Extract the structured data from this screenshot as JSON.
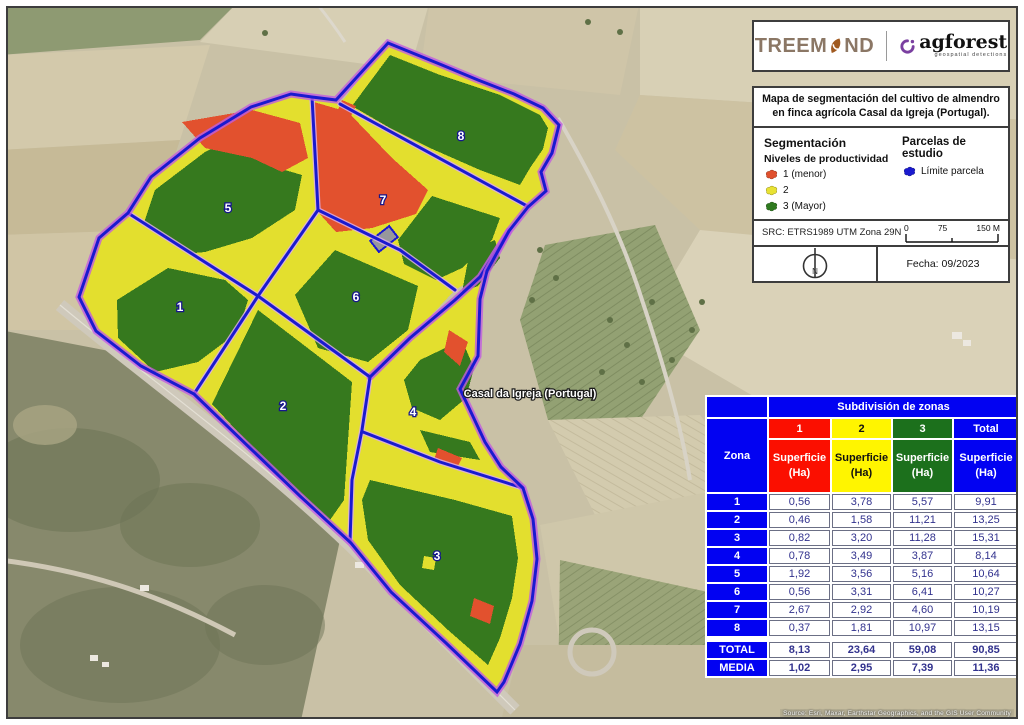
{
  "header": {
    "treemond_part1": "TREEM",
    "treemond_part2": "ND",
    "agforest_name": "agforest",
    "agforest_tagline": "geospatial detections"
  },
  "info": {
    "title_line1": "Mapa de segmentación del cultivo de almendro",
    "title_line2": "en finca agrícola Casal da Igreja (Portugal).",
    "segmentacion_heading": "Segmentación",
    "niveles_heading": "Niveles de productividad",
    "levels": [
      {
        "label": "1 (menor)",
        "color": "#e0502d"
      },
      {
        "label": "2",
        "color": "#e8e233"
      },
      {
        "label": "3 (Mayor)",
        "color": "#2f7a1f"
      }
    ],
    "parcelas_heading": "Parcelas de estudio",
    "limite": {
      "label": "Límite parcela",
      "color": "#1a1acf"
    },
    "src": "SRC: ETRS1989 UTM Zona 29N",
    "scale_ticks": [
      "0",
      "75",
      "150 M"
    ],
    "north": "N",
    "fecha": "Fecha: 09/2023"
  },
  "map": {
    "place_label": "Casal da Igreja (Portugal)",
    "zone_labels": [
      "1",
      "2",
      "3",
      "4",
      "5",
      "6",
      "7",
      "8"
    ],
    "attribution": "Source: Esri, Maxar, Earthstar Geographics, and the GIS User Community"
  },
  "table": {
    "title": "Subdivisión de zonas",
    "zona_header": "Zona",
    "cols": [
      {
        "label": "1",
        "color": "#fb0f00"
      },
      {
        "label": "2",
        "color": "#fff500"
      },
      {
        "label": "3",
        "color": "#1c701c"
      },
      {
        "label": "Total",
        "color": "#0202f2"
      }
    ],
    "superficie": "Superficie",
    "ha": "(Ha)",
    "rows": [
      {
        "z": "1",
        "v": [
          "0,56",
          "3,78",
          "5,57",
          "9,91"
        ]
      },
      {
        "z": "2",
        "v": [
          "0,46",
          "1,58",
          "11,21",
          "13,25"
        ]
      },
      {
        "z": "3",
        "v": [
          "0,82",
          "3,20",
          "11,28",
          "15,31"
        ]
      },
      {
        "z": "4",
        "v": [
          "0,78",
          "3,49",
          "3,87",
          "8,14"
        ]
      },
      {
        "z": "5",
        "v": [
          "1,92",
          "3,56",
          "5,16",
          "10,64"
        ]
      },
      {
        "z": "6",
        "v": [
          "0,56",
          "3,31",
          "6,41",
          "10,27"
        ]
      },
      {
        "z": "7",
        "v": [
          "2,67",
          "2,92",
          "4,60",
          "10,19"
        ]
      },
      {
        "z": "8",
        "v": [
          "0,37",
          "1,81",
          "10,97",
          "13,15"
        ]
      }
    ],
    "total": {
      "label": "TOTAL",
      "v": [
        "8,13",
        "23,64",
        "59,08",
        "90,85"
      ]
    },
    "media": {
      "label": "MEDIA",
      "v": [
        "1,02",
        "2,95",
        "7,39",
        "11,36"
      ]
    }
  },
  "colors": {
    "productivity_low_red": "#e2512e",
    "productivity_mid_yellow": "#e3df2e",
    "productivity_high_green": "#36791e",
    "parcel_boundary_blue": "#1a1acf",
    "boundary_casing_purple": "#c05ce0",
    "table_header_blue": "#0202f2",
    "table_data_text": "#32328e"
  }
}
